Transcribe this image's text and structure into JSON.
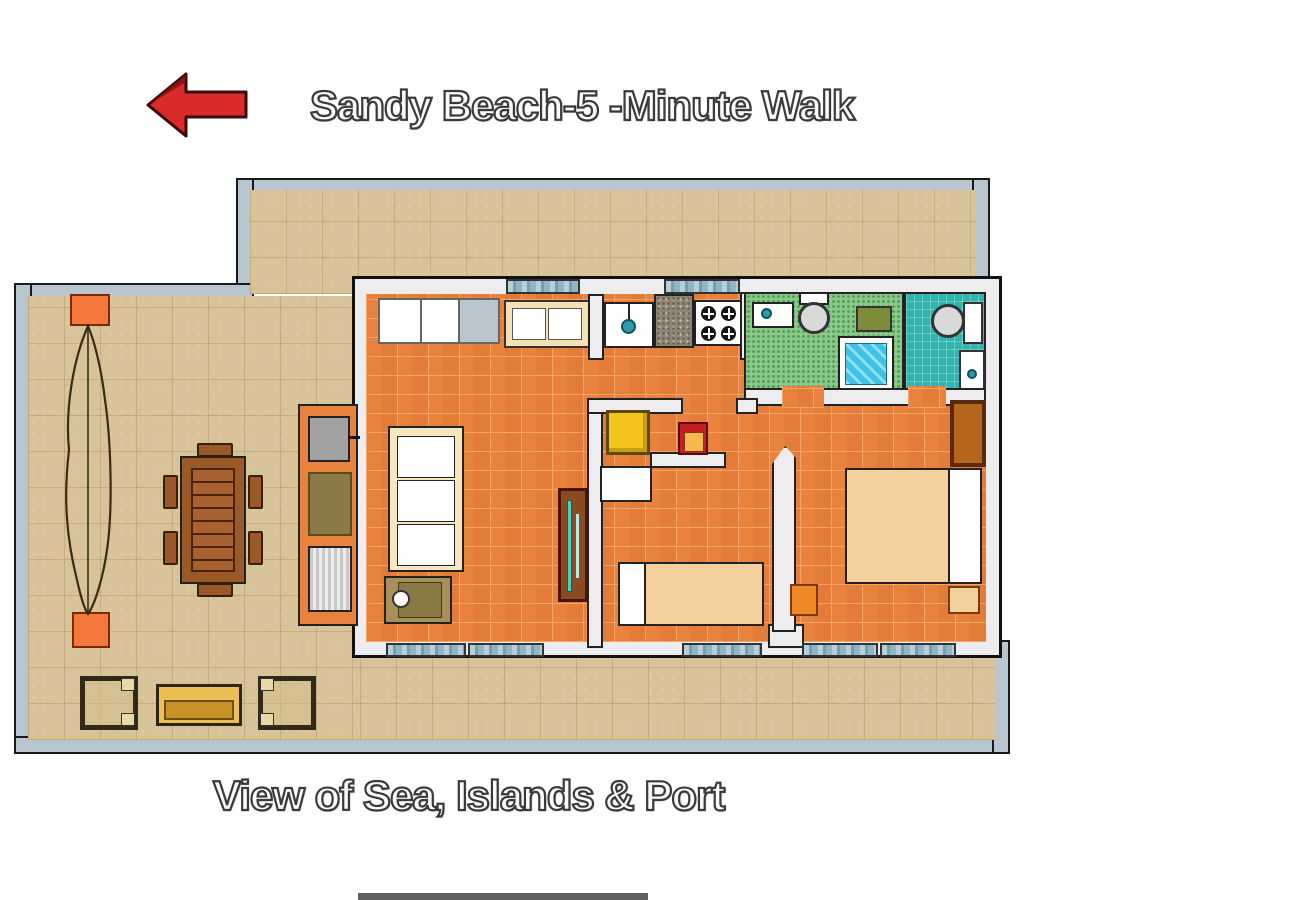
{
  "header": {
    "title": "Sandy Beach-5 -Minute Walk",
    "arrow_direction": "left"
  },
  "footer": {
    "caption": "View of Sea, Islands & Port"
  },
  "plan": {
    "type": "floor-plan",
    "areas": [
      "terrace",
      "living-room",
      "kitchen",
      "green-bathroom",
      "teal-bathroom",
      "single-bedroom",
      "double-bedroom",
      "hallway"
    ],
    "terrace_items": [
      "planter-top",
      "planter-bottom",
      "plant",
      "dining-table",
      "dining-chairs-x6",
      "armchair-left",
      "bench",
      "armchair-right",
      "bbq-grill",
      "outdoor-counter",
      "grill-grate"
    ],
    "living_room_items": [
      "sofa-3-seat",
      "coffee-table",
      "tv-cabinet",
      "sideboard",
      "window-row"
    ],
    "kitchen_items": [
      "sink-unit",
      "granite-counter",
      "gas-stove-4-burner"
    ],
    "green_bathroom_items": [
      "washbasin",
      "toilet",
      "bath-mat",
      "shower"
    ],
    "teal_bathroom_items": [
      "toilet",
      "bidet-basin"
    ],
    "single_bedroom_items": [
      "single-bed",
      "yellow-table",
      "red-cabinet",
      "closet"
    ],
    "double_bedroom_items": [
      "double-bed",
      "wardrobe",
      "nightstand-orange",
      "nightstand-tan",
      "door-leaf"
    ]
  },
  "palette": {
    "page_bg": "#ffffff",
    "outer_wall": "#b9c6cf",
    "outline": "#1a1a1a",
    "terrace_tile": "#d8c298",
    "interior_wall": "#ededef",
    "floor_tile": "#e8823c",
    "floor_grout": "#f5a468",
    "green_bath": "#8cc88c",
    "teal_bath": "#2fb5ae",
    "shower_water": "#3ec2e8",
    "granite": "#8f8576",
    "cabinet_cream": "#f5dfb5",
    "sofa_cream": "#f6e6c0",
    "bed_tan": "#f4d09c",
    "wood_brown": "#9a5a28",
    "wood_dark": "#4a2408",
    "bench_gold": "#ecbf55",
    "bench_gold_dark": "#c89228",
    "planter_orange": "#f4783c",
    "accent_orange": "#f08828",
    "table_yellow": "#f4c41c",
    "accent_red": "#c42020",
    "bbq_gray": "#a2a2a2",
    "olive": "#7d8c3a",
    "shelf_brown": "#8a4a22",
    "teal_accent": "#4ad0c0",
    "window_glass": "#8fb6c4",
    "arrow_red": "#d92b2b",
    "title_fill": "#fbfbfb",
    "title_stroke": "#3a3a3a"
  }
}
